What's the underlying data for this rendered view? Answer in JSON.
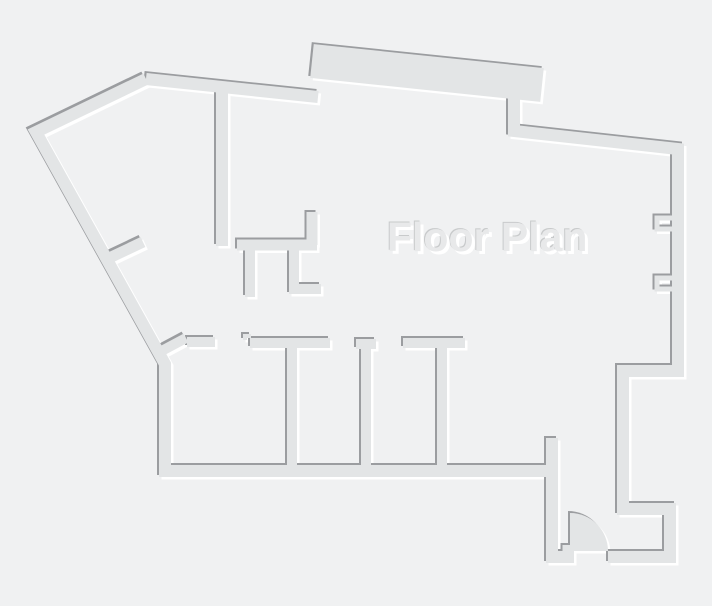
{
  "title": "Floor Plan",
  "colors": {
    "background": "#f0f1f2",
    "wall_fill": "#e3e5e6",
    "wall_shadow_dark": "#9b9da0",
    "wall_highlight": "#ffffff",
    "title_fill": "#e8e9ea",
    "title_edge_shadow": "#c8cacb"
  },
  "diagram": {
    "type": "floor-plan",
    "features": {
      "door_swing": "quarter-circle door at bottom-right entry, hinge on left jamb",
      "window_jambs": "two bracket pairs on right exterior wall",
      "rooms_bottom_row": 4,
      "top_band": "thick angled wall section at top center"
    }
  }
}
